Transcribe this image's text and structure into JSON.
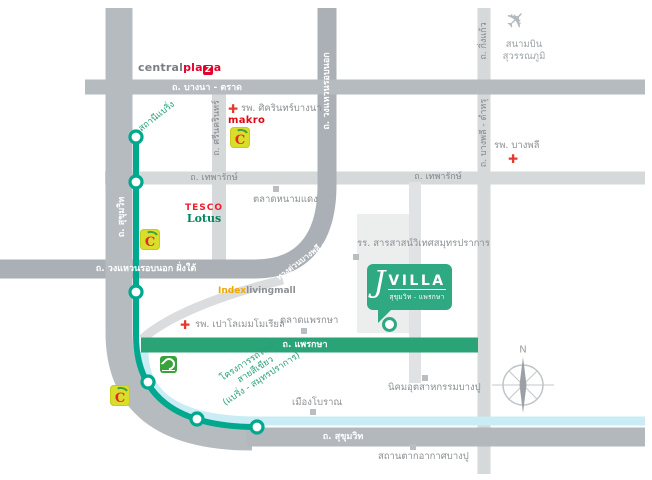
{
  "brands": {
    "central_plaza": {
      "central": "central",
      "pla": "pla",
      "z": "Z",
      "a": "a"
    },
    "makro": "makro",
    "tesco": "TESCO",
    "lotus": "Lotus",
    "index": "Index",
    "livingmall": "livingmall",
    "big_c": "C"
  },
  "roads": {
    "bangna_trat": "ถ. บางนา - ตราด",
    "srinakarin": "ถ. ศรีนครินทร์",
    "theparak_left": "ถ. เทพารักษ์",
    "theparak_right": "ถ. เทพารักษ์",
    "kingkaew": "ถ. กิ่งแก้ว",
    "bangphli_tamru": "ถ. บางพลี - ตำหรุ",
    "outer_ring": "ถ. วงแหวนรอบนอก",
    "outer_ring_south": "ถ. วงแหวนรอบนอก ฝั่งใต้",
    "expressway": "ทางด่วนบางพลี - สุขสวัสดิ์",
    "sukhumvit_left": "ถ. สุขุมวิท",
    "sukhumvit_bottom": "ถ. สุขุมวิท",
    "phraeksa": "ถ. แพรกษา"
  },
  "transit": {
    "bearing_station": "สถานีแบริ่ง",
    "green_line_project_line1": "โครงการรถไฟฟ้า",
    "green_line_project_line2": "สายสีเขียว",
    "green_line_project_line3": "(แบริ่ง - สมุทรปราการ)"
  },
  "landmarks": {
    "sikarin_hospital": "รพ. ศิครินทร์บางนา",
    "bangphli_hospital": "รพ. บางพลี",
    "paolo_hospital": "รพ. เปาโลเมมโมเรียล",
    "namdaeng_market": "ตลาดหนามแดง",
    "phraeksa_market": "ตลาดแพรกษา",
    "sarasas_school": "รร. สารสาสน์วิเทศสมุทรปราการ",
    "ancient_city": "เมืองโบราณ",
    "bangpu_industrial_estate": "นิคมอุตสาหกรรมบางปู",
    "bangpu_recreation": "สถานตากอากาศบางปู",
    "airport_line1": "สนามบิน",
    "airport_line2": "สุวรรณภูมิ"
  },
  "project": {
    "j": "J",
    "name": "VILLA",
    "subtitle": "สุขุมวิท - แพรกษา"
  },
  "compass": {
    "north": "N"
  },
  "icons": {
    "airplane": "airplane-icon",
    "hospital_cross": "red-cross-icon",
    "big_c": "big-c-store-icon",
    "green_square": "green-brand-icon",
    "station": "bts-station-icon",
    "compass": "compass-rose-icon"
  },
  "colors": {
    "bts_green": "#00a88e",
    "road_green": "#2aa377",
    "brand_green": "#2fa982",
    "canal_blue": "#c9ecf5",
    "road_gray": "#b6bbbf",
    "road_light": "#d6d9da",
    "hospital_red": "#e23b32",
    "text_gray": "#8b9094"
  }
}
